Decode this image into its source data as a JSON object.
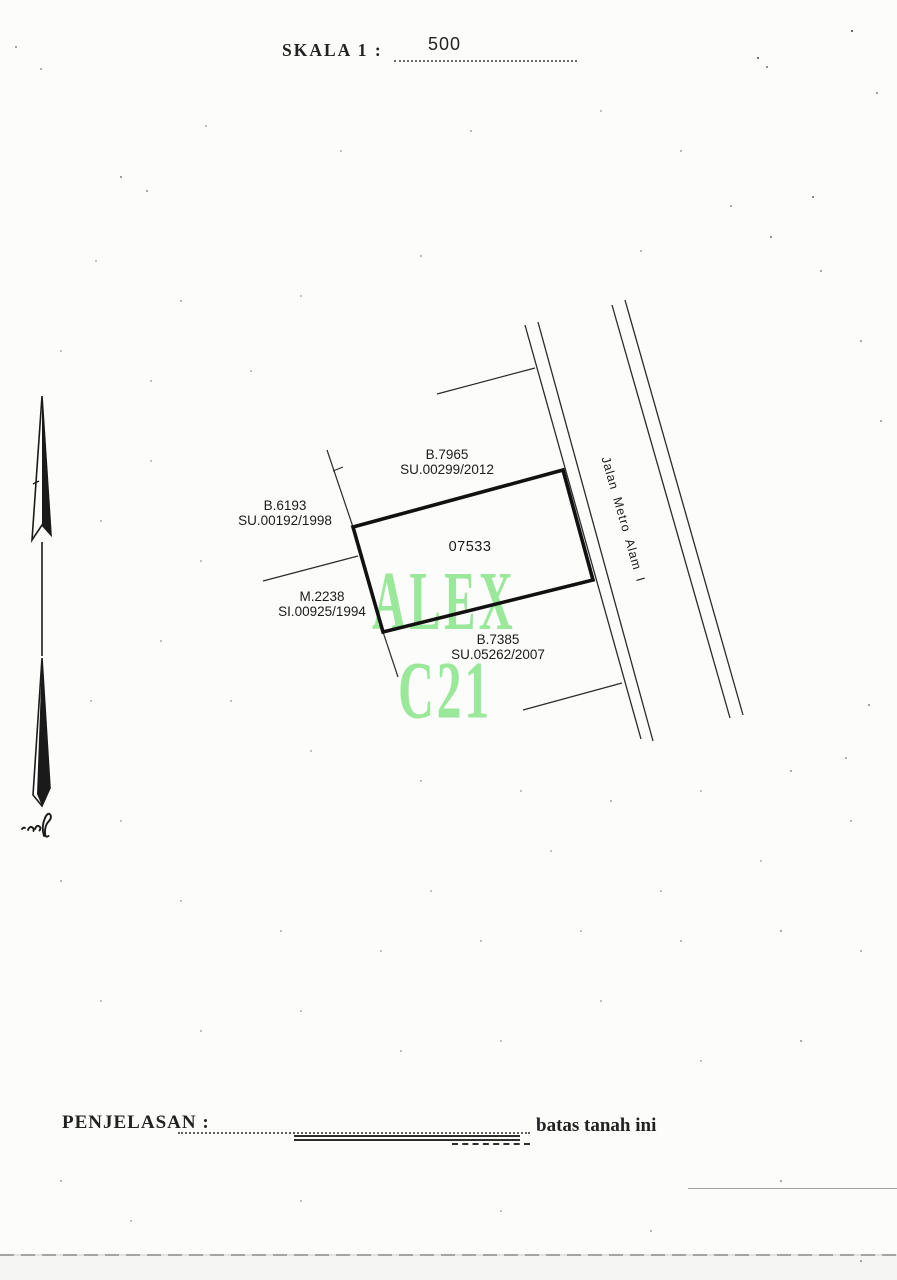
{
  "scale": {
    "label": "SKALA 1 :",
    "value": "500"
  },
  "map": {
    "parcel_number": "07533",
    "road_label": "Jalan Metro Alam I",
    "neighbors": [
      {
        "id": "B.7965",
        "doc": "SU.00299/2012"
      },
      {
        "id": "B.6193",
        "doc": "SU.00192/1998"
      },
      {
        "id": "M.2238",
        "doc": "SI.00925/1994"
      },
      {
        "id": "B.7385",
        "doc": "SU.05262/2007"
      }
    ]
  },
  "watermark": {
    "line1": "ALEX",
    "line2": "C21",
    "color": "#9ae89a"
  },
  "legend": {
    "label": "PENJELASAN  :",
    "note": "batas tanah ini"
  },
  "colors": {
    "ink": "#1d1d1d",
    "paper": "#fcfcfa",
    "boundary": "#111111"
  }
}
